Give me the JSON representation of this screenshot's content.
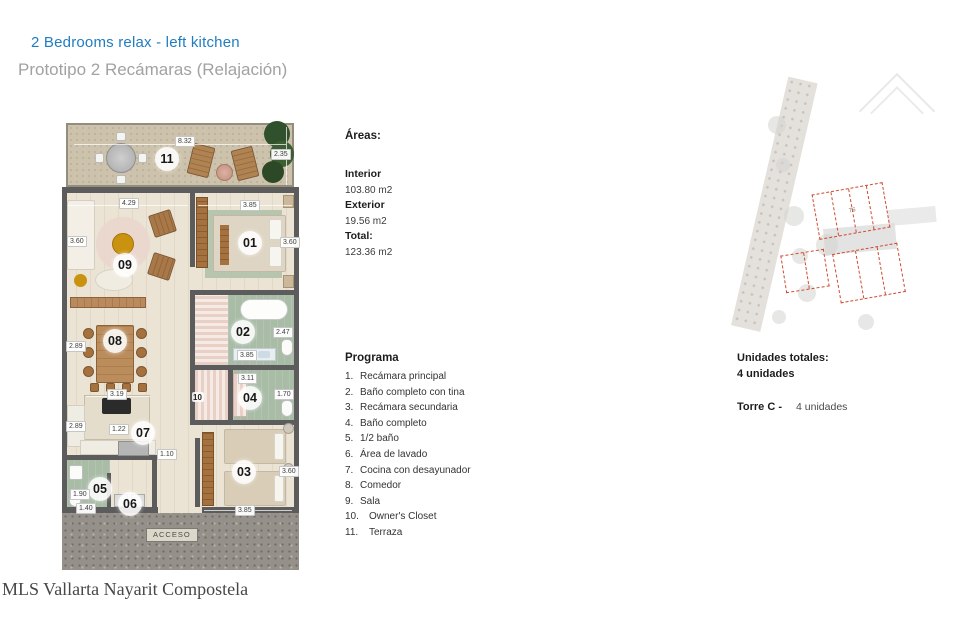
{
  "page": {
    "title": "2 Bedrooms relax - left kitchen",
    "subtitle": "Prototipo 2 Recámaras (Relajación)",
    "watermark": "MLS Vallarta Nayarit Compostela"
  },
  "areas": {
    "heading": "Áreas:",
    "interior_label": "Interior",
    "interior_value": "103.80 m2",
    "exterior_label": "Exterior",
    "exterior_value": "19.56 m2",
    "total_label": "Total:",
    "total_value": "123.36 m2"
  },
  "programa": {
    "heading": "Programa",
    "items": [
      {
        "num": "1.",
        "label": "Recámara principal"
      },
      {
        "num": "2.",
        "label": "Baño completo con tina"
      },
      {
        "num": "3.",
        "label": "Recámara secundaria"
      },
      {
        "num": "4.",
        "label": "Baño completo"
      },
      {
        "num": "5.",
        "label": "1/2 baño"
      },
      {
        "num": "6.",
        "label": "Área de lavado"
      },
      {
        "num": "7.",
        "label": "Cocina con desayunador"
      },
      {
        "num": "8.",
        "label": "Comedor"
      },
      {
        "num": "9.",
        "label": "Sala"
      },
      {
        "num": "10.",
        "label": "Owner's Closet"
      },
      {
        "num": "11.",
        "label": "Terraza"
      }
    ]
  },
  "unidades": {
    "heading": "Unidades totales:",
    "total": "4 unidades",
    "tower_label": "Torre C -",
    "tower_value": "4 unidades"
  },
  "floorplan": {
    "acceso": "ACCESO",
    "rooms": {
      "r01": "01",
      "r02": "02",
      "r03": "03",
      "r04": "04",
      "r05": "05",
      "r06": "06",
      "r07": "07",
      "r08": "08",
      "r09": "09",
      "r10": "10",
      "r11": "11"
    },
    "dims": {
      "terraza_w": "8.32",
      "terraza_d": "2.35",
      "sala_w": "4.29",
      "sala_d": "3.60",
      "rec_principal_w": "3.85",
      "rec_principal_d": "3.60",
      "comedor_d": "2.89",
      "bano_tina_d": "2.47",
      "bano_tina_w": "3.85",
      "bano2_w": "3.11",
      "bano2_d": "1.70",
      "cocina_w": "3.19",
      "cocina_isla": "1.22",
      "cocina_d": "2.89",
      "pasillo": "1.10",
      "medio_bano_d": "1.90",
      "medio_bano_w": "1.40",
      "rec_secundaria_d": "3.60",
      "rec_secundaria_w": "3.85"
    }
  },
  "siteplan": {
    "unit_label": "76"
  },
  "colors": {
    "accent_blue": "#1f7dc2",
    "wall": "#5c5c5c",
    "bath_green": "#a8bca6",
    "site_red": "#cf4a2e"
  }
}
